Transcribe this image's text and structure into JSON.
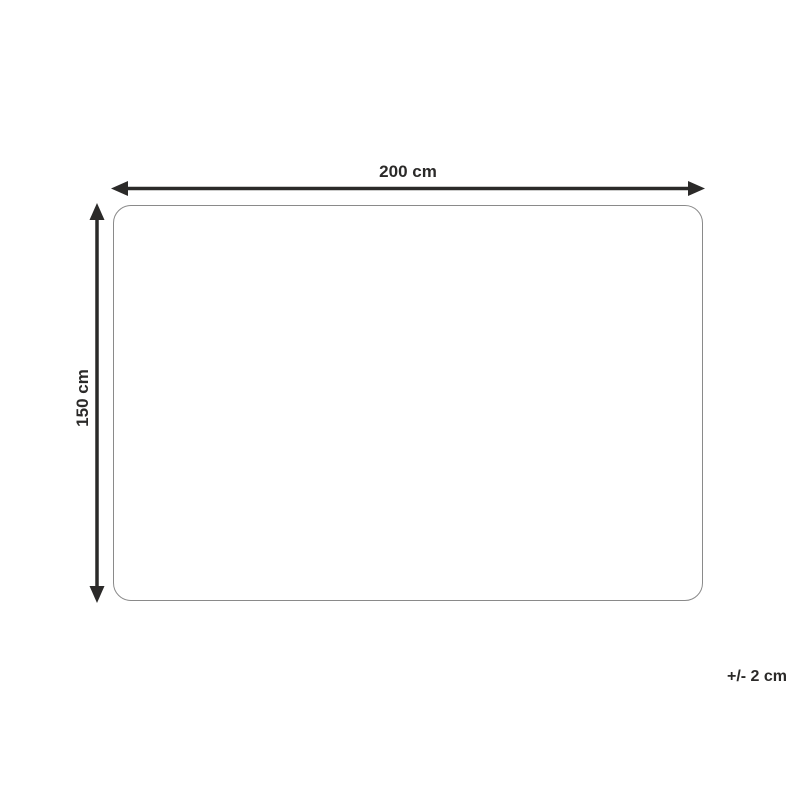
{
  "diagram": {
    "width_label": "200 cm",
    "height_label": "150 cm",
    "tolerance_note": "+/- 2 cm"
  },
  "colors": {
    "arrow": "#2b2a29",
    "text": "#2b2a29",
    "outline": "#8a8a8a",
    "background": "#ffffff"
  }
}
